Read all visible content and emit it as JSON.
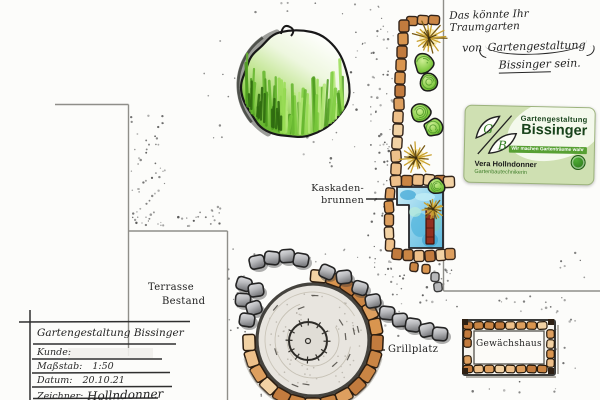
{
  "plan": {
    "labels": {
      "kaskadenbrunnen_line1": "Kaskaden-",
      "kaskadenbrunnen_line2": "brunnen",
      "terrasse_line1": "Terrasse",
      "terrasse_line2": "Bestand",
      "grillplatz": "Grillplatz",
      "gewaechshaus": "Gewächshaus"
    },
    "handwriting": {
      "line1": "Das könnte Ihr Traumgarten",
      "line2_prefix": "von",
      "line2_emphasis": "Gartengestaltung",
      "line3_emphasis": "Bissinger",
      "line3_suffix": "sein."
    },
    "title_block": {
      "header": "Gartengestaltung Bissinger",
      "rows": [
        {
          "label": "Kunde:",
          "value": ""
        },
        {
          "label": "Maßstab:",
          "value": "1:50"
        },
        {
          "label": "Datum:",
          "value": "20.10.21"
        },
        {
          "label": "Zeichner:",
          "value": "Hollndonner"
        }
      ]
    }
  },
  "business_card": {
    "logo_letters": [
      "G",
      "B"
    ],
    "company_line1": "Gartengestaltung",
    "company_line2": "Bissinger",
    "tagline": "Wir machen Gartenträume wahr",
    "person_name": "Vera Hollndonner",
    "person_title": "Gartenbautechnikerin",
    "colors": {
      "card_bg": "#cfe0b2",
      "text_green": "#17421a",
      "chip_green": "#57a033",
      "badge_green": "#2e7d22"
    }
  },
  "drawing_colors": {
    "paper": "#fcfcfa",
    "ink": "#262626",
    "pencil_line": "#8f8e89",
    "tan_stone": "#dd9f5f",
    "gray_stone": "#9598a0",
    "water_blue": "#7cc6e6",
    "tree_green": "#6ab32e",
    "red_brick": "#8e2f23"
  }
}
